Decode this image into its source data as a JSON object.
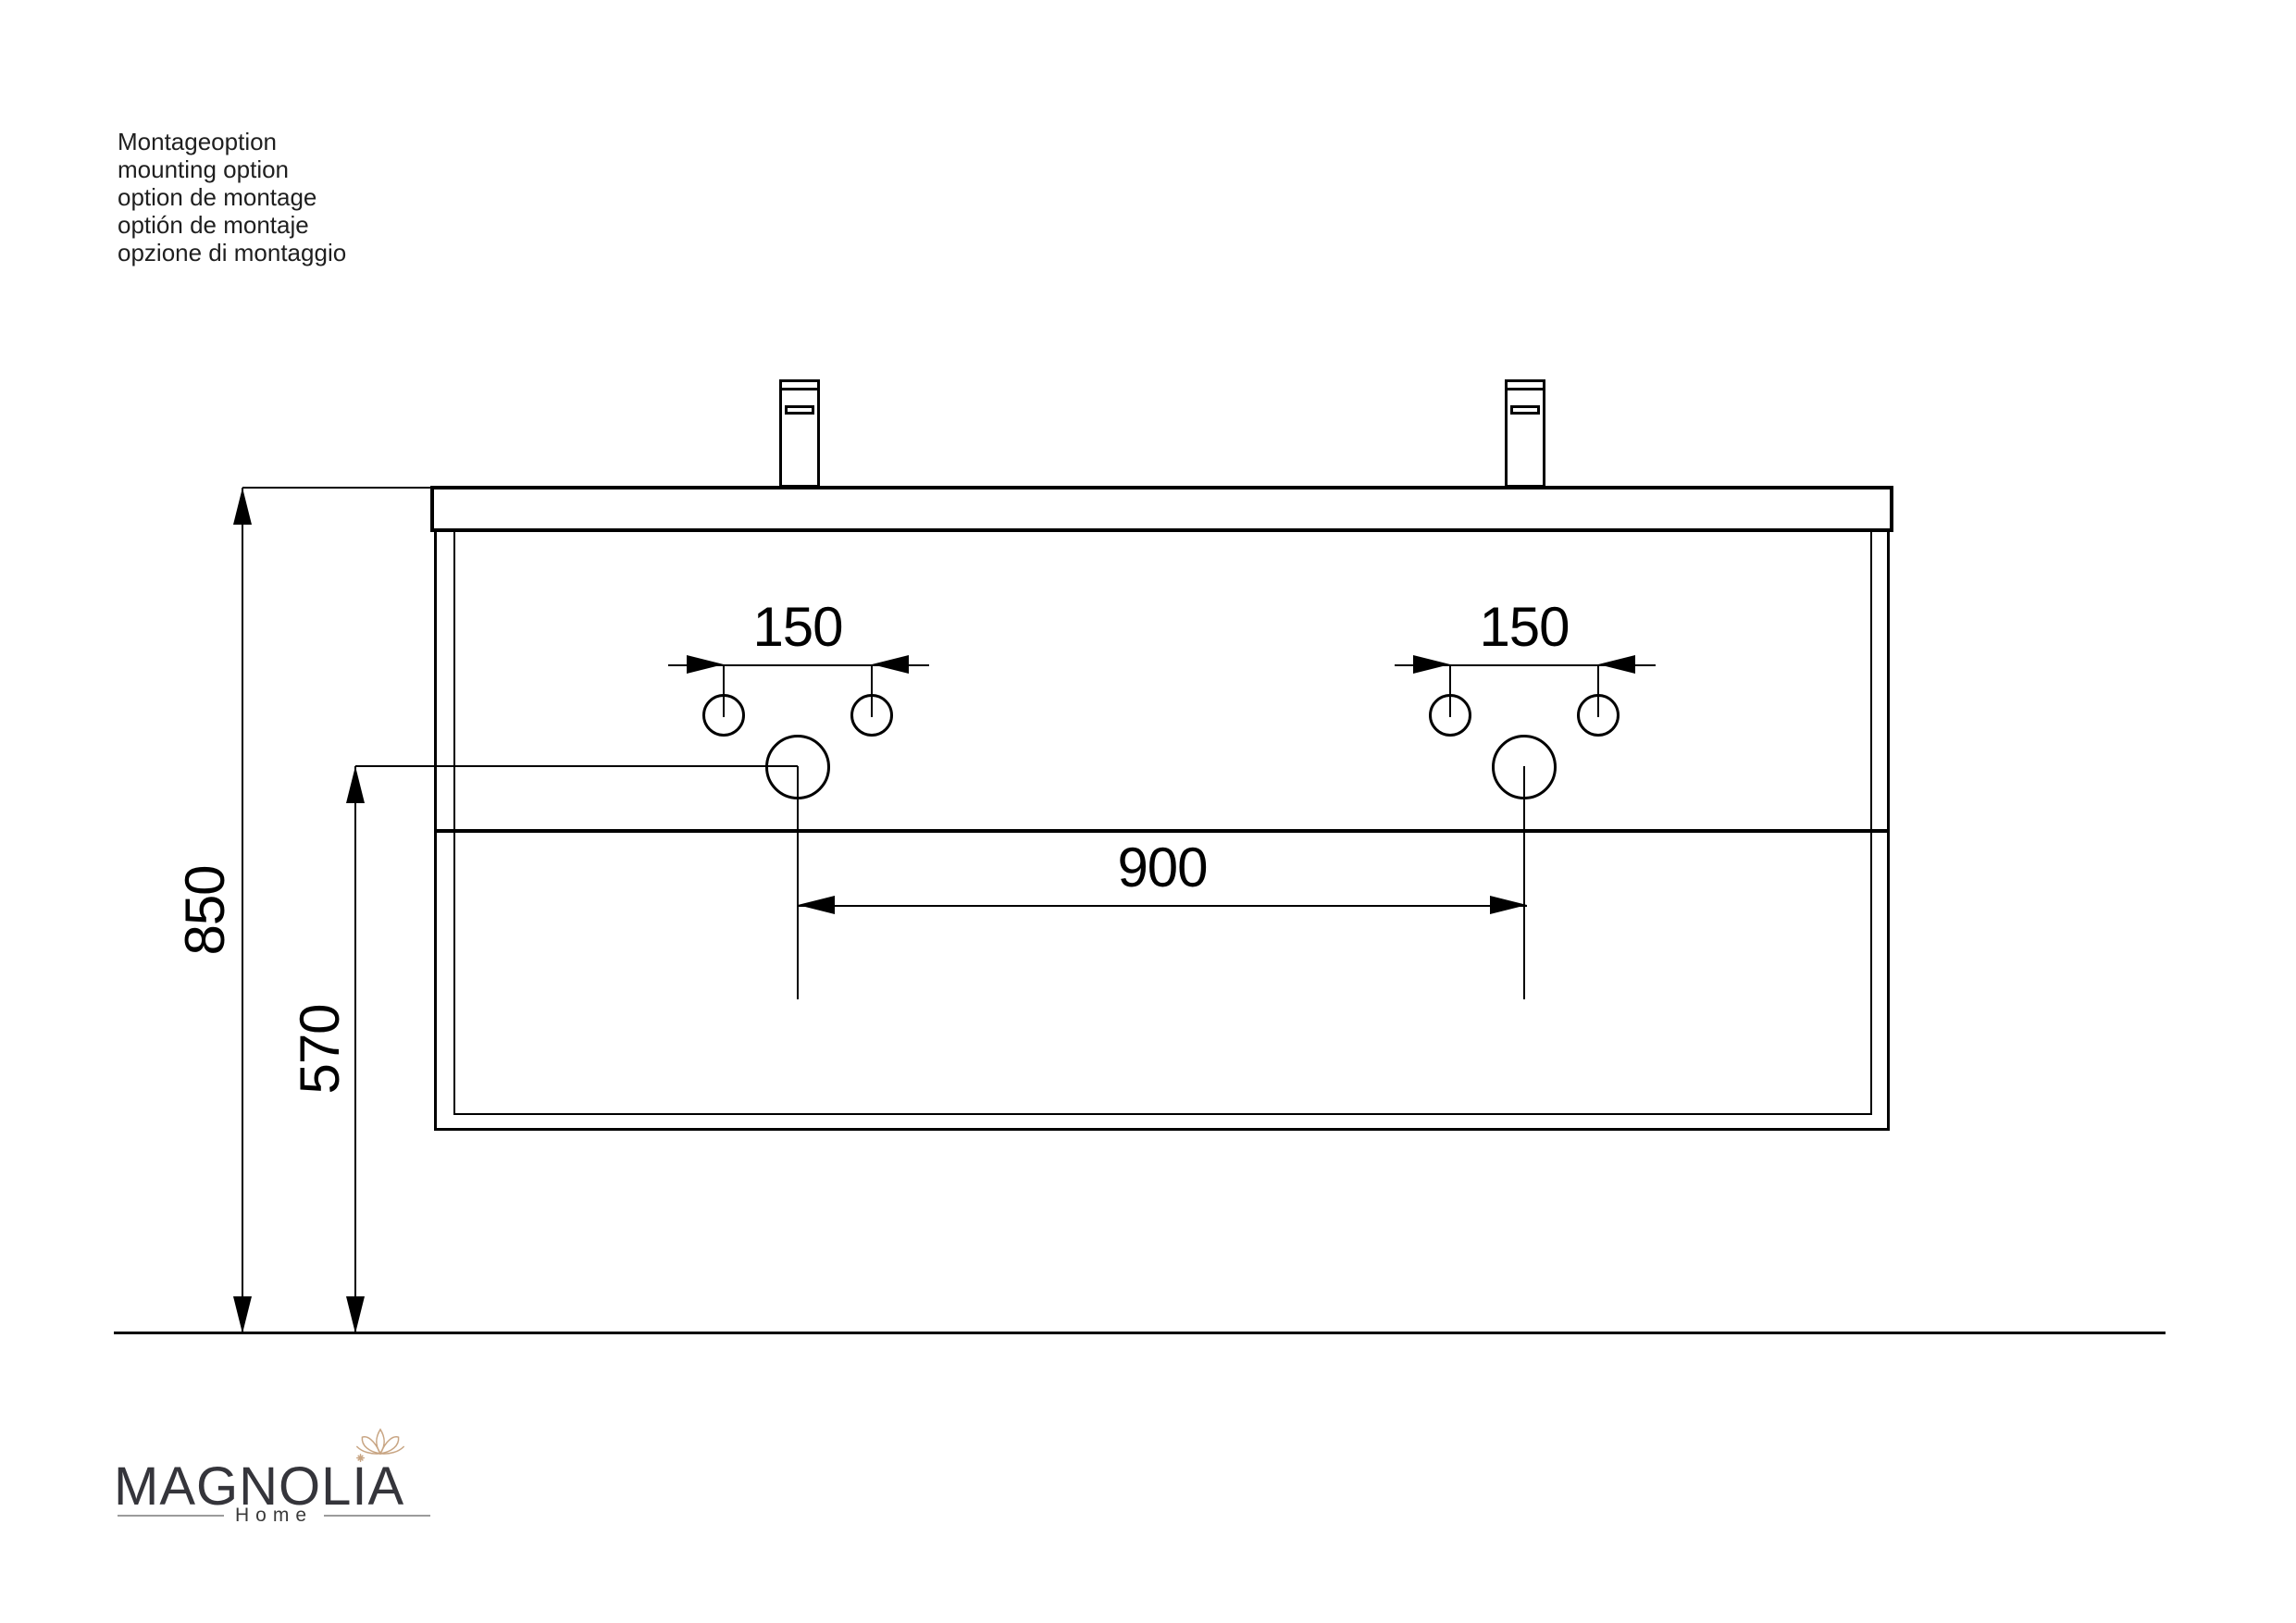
{
  "info_block": {
    "lines": [
      "Montageoption",
      "mounting option",
      "option de montage",
      "optión de montaje",
      "opzione di montaggio"
    ]
  },
  "drawing": {
    "dim_tap_spacing_left": "150",
    "dim_tap_spacing_right": "150",
    "dim_basin_centers": "900",
    "dim_height_total": "850",
    "dim_height_underside": "570"
  },
  "logo": {
    "brand": "MAGNOLIA",
    "subtitle": "Home"
  },
  "colors": {
    "line": "#000000",
    "text": "#1f1f1f",
    "logo_text": "#35353b",
    "logo_flower": "#c8a583",
    "logo_rule": "#9b9b9b"
  }
}
